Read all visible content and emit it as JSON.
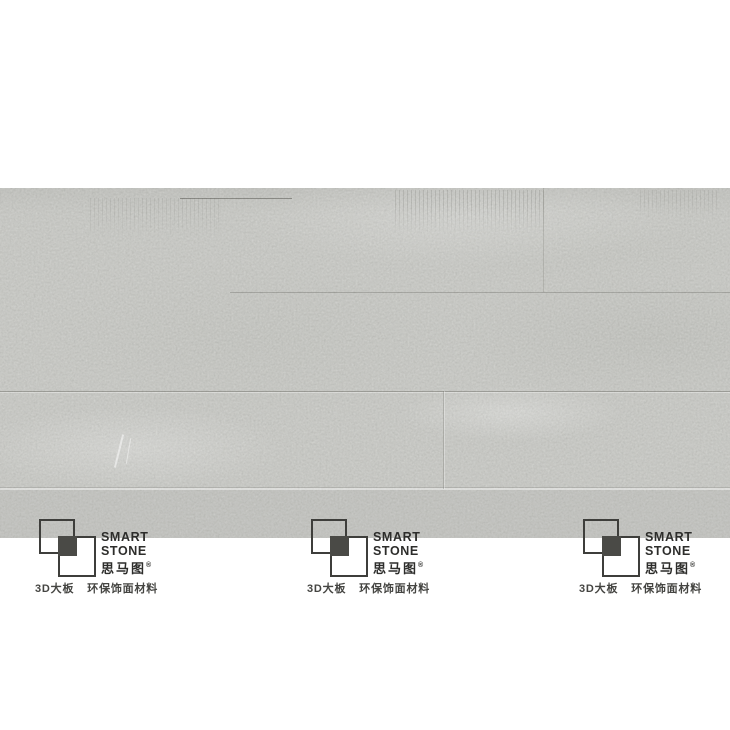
{
  "brand": {
    "name_en_line1": "SMART",
    "name_en_line2": "STONE",
    "name_cn": "思马图",
    "registered_mark": "®",
    "tagline_product": "3D大板",
    "tagline_material": "环保饰面材料"
  },
  "colors": {
    "page_background": "#ffffff",
    "panel_gray": "#c6c7c3",
    "logo_outline": "#3e3e3b",
    "logo_overlap_fill": "#4a4a46",
    "brand_text": "#2d2d2b",
    "tagline_text": "#454542"
  }
}
